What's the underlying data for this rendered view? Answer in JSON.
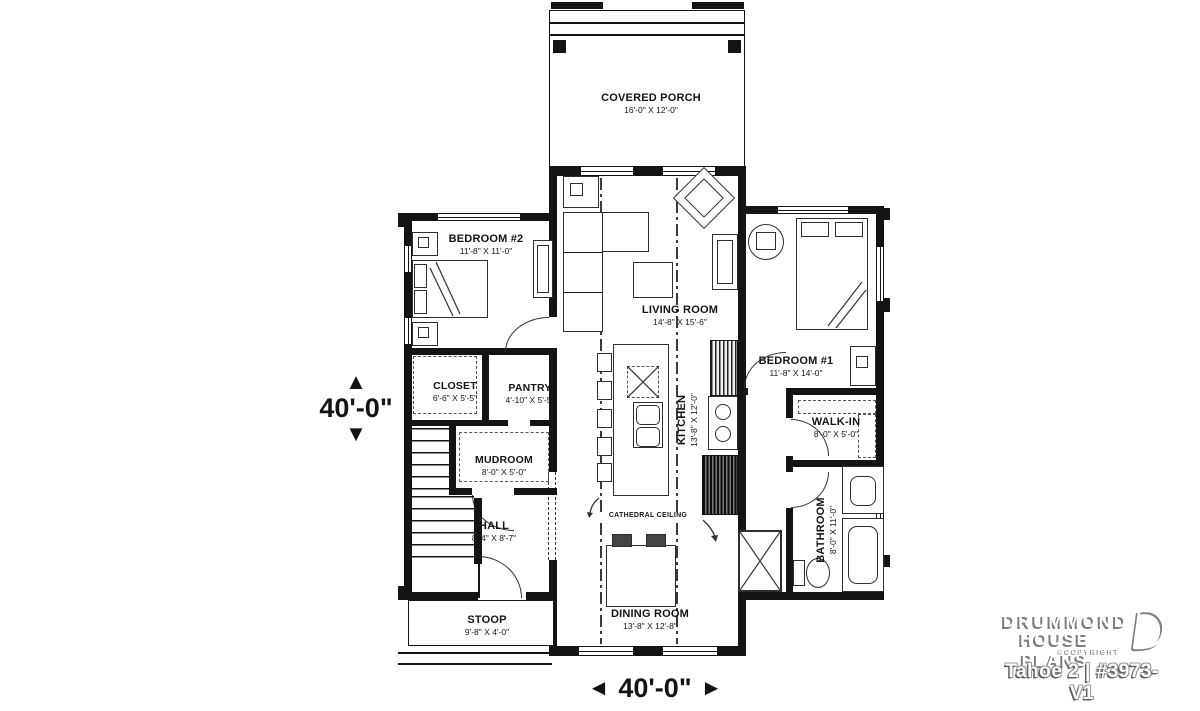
{
  "rooms": [
    {
      "name": "COVERED PORCH",
      "dims": "16'-0\" X 12'-0\""
    },
    {
      "name": "BEDROOM #2",
      "dims": "11'-8\" X 11'-0\""
    },
    {
      "name": "LIVING ROOM",
      "dims": "14'-8\" X 15'-6\""
    },
    {
      "name": "BEDROOM #1",
      "dims": "11'-8\" X 14'-0\""
    },
    {
      "name": "CLOSET",
      "dims": "6'-6\" X 5'-5\""
    },
    {
      "name": "PANTRY",
      "dims": "4'-10\" X 5'-5\""
    },
    {
      "name": "KITCHEN",
      "dims": "13'-8\" X 12'-0\""
    },
    {
      "name": "MUDROOM",
      "dims": "8'-0\" X 5'-0\""
    },
    {
      "name": "HALL",
      "dims": "8'-4\" X 8'-7\""
    },
    {
      "name": "WALK-IN",
      "dims": "8'-0\" X 5'-0\""
    },
    {
      "name": "BATHROOM",
      "dims": "8'-0\" X 11'-0\""
    },
    {
      "name": "DINING ROOM",
      "dims": "13'-8\" X 12'-8\""
    },
    {
      "name": "STOOP",
      "dims": "9'-8\" X 4'-0\""
    }
  ],
  "annotations": {
    "cathedral_ceiling": "CATHEDRAL CEILING"
  },
  "dimensions": {
    "vertical": "40'-0\"",
    "horizontal": "40'-0\""
  },
  "icons": {
    "arrow_up": "▲",
    "arrow_down": "▼",
    "arrow_left": "◄",
    "arrow_right": "►"
  },
  "branding": {
    "line1": "DRUMMOND",
    "line2": "HOUSE PLANS",
    "copyright": "©COPYRIGHT",
    "plan_name": "Tahoe 2 | #3973-V1"
  },
  "colors": {
    "ink": "#141414",
    "logo_shadow": "#7d7d7d",
    "background": "#ffffff"
  }
}
